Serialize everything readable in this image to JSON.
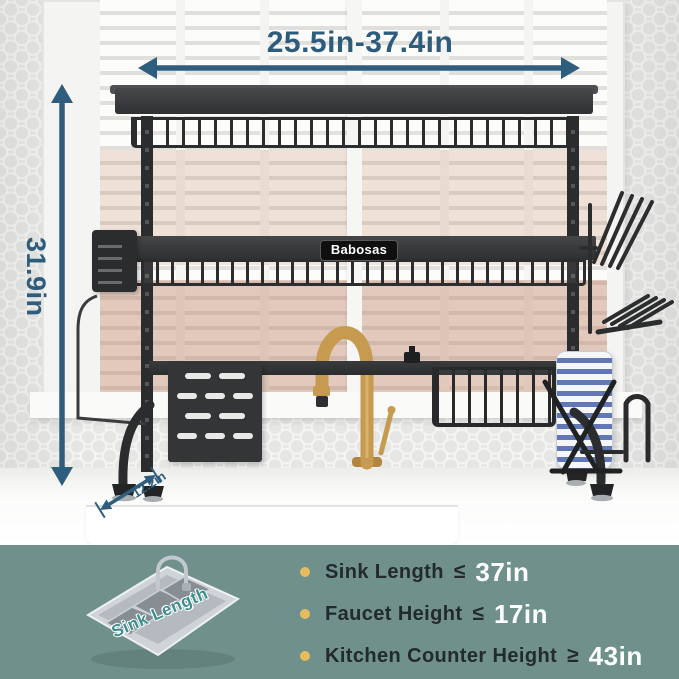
{
  "annotations": {
    "width_label": "25.5in-37.4in",
    "height_label": "31.9in",
    "depth_label": "12.2in"
  },
  "product": {
    "brand": "Babosas"
  },
  "specs": {
    "items": [
      {
        "label": "Sink Length",
        "operator": "≤",
        "value": "37in"
      },
      {
        "label": "Faucet Height",
        "operator": "≤",
        "value": "17in"
      },
      {
        "label": "Kitchen Counter Height",
        "operator": "≥",
        "value": "43in"
      }
    ]
  },
  "inset": {
    "caption": "Sink Length"
  },
  "colors": {
    "annotation_arrow": "#2f5d7d",
    "band_background": "#70918b",
    "bullet": "#e7bc5e",
    "spec_label": "#232a2c",
    "spec_value": "#ffffff",
    "brand_background": "#0f0f10",
    "brand_text": "#ffffff",
    "rack_black": "#2b2c2e",
    "faucet_gold": "#c69a4f",
    "plate_blue": "#6277b5",
    "inset_caption": "#3f8e8e"
  }
}
